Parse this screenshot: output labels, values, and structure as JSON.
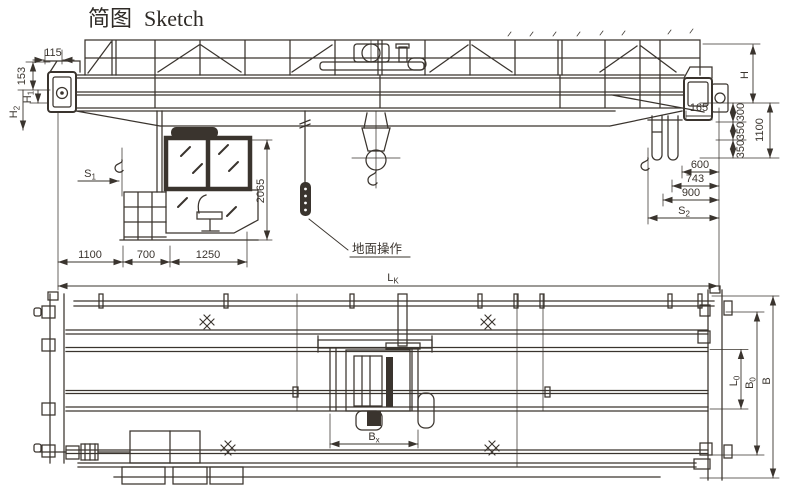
{
  "title": {
    "cn": "简图",
    "en": "Sketch"
  },
  "colors": {
    "ink": "#3a342e",
    "background": "#ffffff"
  },
  "elevation": {
    "pendant_label": "地面操作",
    "dims": {
      "d115": "115",
      "d153": "153",
      "h1": {
        "base": "H",
        "sub": "1"
      },
      "h2": {
        "base": "H",
        "sub": "2"
      },
      "s1": {
        "base": "S",
        "sub": "1"
      },
      "cab": "2065",
      "b1100": "1100",
      "b700": "700",
      "b1250": "1250",
      "span": {
        "base": "L",
        "sub": "K"
      },
      "h": "H",
      "d165": "165",
      "d300": "300",
      "d350a": "350",
      "d350b": "350",
      "r1100": "1100",
      "d600": "600",
      "d743": "743",
      "d900": "900",
      "s2": {
        "base": "S",
        "sub": "2"
      }
    }
  },
  "plan": {
    "dims": {
      "bx": {
        "base": "B",
        "sub": "x"
      },
      "l0": {
        "base": "L",
        "sub": "0"
      },
      "b0": {
        "base": "B",
        "sub": "0"
      },
      "b": "B"
    }
  }
}
